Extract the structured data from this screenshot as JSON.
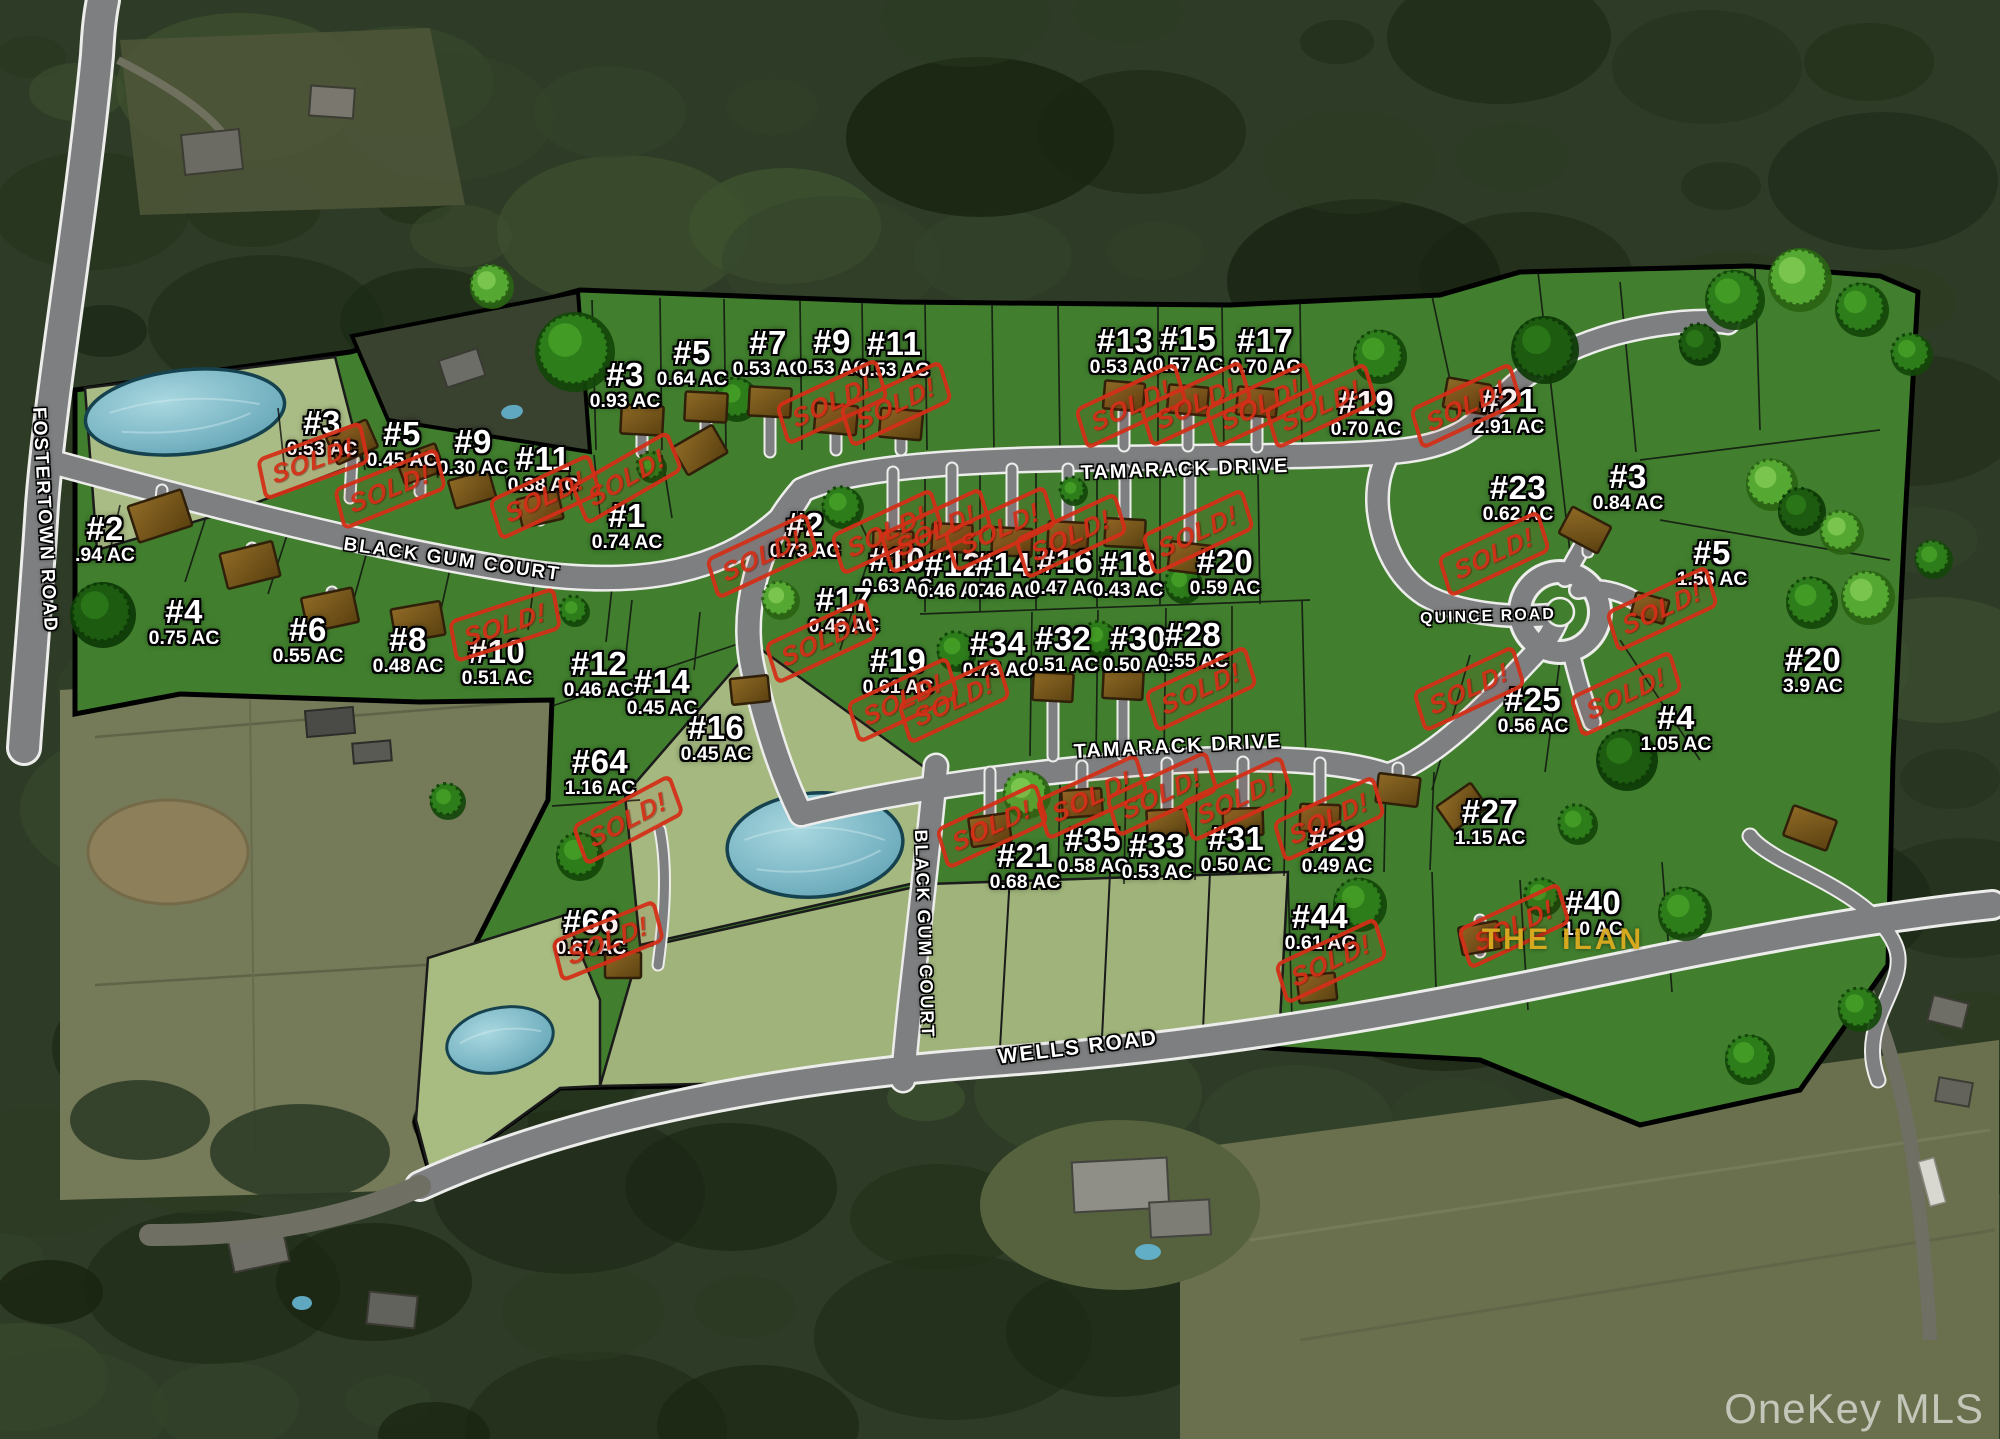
{
  "map": {
    "watermark": "OneKey MLS",
    "overlay_title": "THE ILAN",
    "sold_label": "SOLD!",
    "colors": {
      "lot_green": "#417f2e",
      "open_green": "#a6ba80",
      "pond_blue": "#79b9c8",
      "road_gray": "#7d7f80",
      "sold_red": "#d42f17",
      "ilan_gold": "#dcab1f"
    }
  },
  "roads": [
    {
      "label": "FOSTERTOWN ROAD",
      "x": 44,
      "y": 520,
      "rot": 87,
      "size": 19
    },
    {
      "label": "BLACK GUM COURT",
      "x": 452,
      "y": 560,
      "rot": 8,
      "size": 19
    },
    {
      "label": "TAMARACK DRIVE",
      "x": 1185,
      "y": 470,
      "rot": -2,
      "size": 20
    },
    {
      "label": "TAMARACK DRIVE",
      "x": 1178,
      "y": 747,
      "rot": -3,
      "size": 20
    },
    {
      "label": "QUINCE ROAD",
      "x": 1488,
      "y": 617,
      "rot": -2,
      "size": 16
    },
    {
      "label": "BLACK GUM COURT",
      "x": 924,
      "y": 934,
      "rot": 88,
      "size": 18
    },
    {
      "label": "WELLS ROAD",
      "x": 1078,
      "y": 1048,
      "rot": -7,
      "size": 21
    }
  ],
  "lots": [
    {
      "num": "#2",
      "acres": ".94 AC",
      "x": 105,
      "y": 539
    },
    {
      "num": "#3",
      "acres": "0.53 AC",
      "x": 322,
      "y": 433
    },
    {
      "num": "#5",
      "acres": "0.45 AC",
      "x": 402,
      "y": 444
    },
    {
      "num": "#9",
      "acres": "0.30 AC",
      "x": 473,
      "y": 452
    },
    {
      "num": "#11",
      "acres": "0.38 AC",
      "x": 543,
      "y": 469
    },
    {
      "num": "#1",
      "acres": "0.74 AC",
      "x": 627,
      "y": 526
    },
    {
      "num": "#4",
      "acres": "0.75 AC",
      "x": 184,
      "y": 622
    },
    {
      "num": "#6",
      "acres": "0.55 AC",
      "x": 308,
      "y": 640
    },
    {
      "num": "#8",
      "acres": "0.48 AC",
      "x": 408,
      "y": 650
    },
    {
      "num": "#10",
      "acres": "0.51 AC",
      "x": 497,
      "y": 662
    },
    {
      "num": "#12",
      "acres": "0.46 AC",
      "x": 599,
      "y": 674
    },
    {
      "num": "#14",
      "acres": "0.45 AC",
      "x": 662,
      "y": 692
    },
    {
      "num": "#16",
      "acres": "0.45 AC",
      "x": 716,
      "y": 738
    },
    {
      "num": "#64",
      "acres": "1.16 AC",
      "x": 600,
      "y": 772
    },
    {
      "num": "#66",
      "acres": "0.87 AC",
      "x": 591,
      "y": 932
    },
    {
      "num": "#3",
      "acres": "0.93 AC",
      "x": 625,
      "y": 385
    },
    {
      "num": "#5",
      "acres": "0.64 AC",
      "x": 692,
      "y": 363
    },
    {
      "num": "#7",
      "acres": "0.53 AC",
      "x": 768,
      "y": 353
    },
    {
      "num": "#9",
      "acres": "0.53 AC",
      "x": 832,
      "y": 352
    },
    {
      "num": "#11",
      "acres": "0.53 AC",
      "x": 894,
      "y": 354
    },
    {
      "num": "#13",
      "acres": "0.53 AC",
      "x": 1125,
      "y": 351
    },
    {
      "num": "#15",
      "acres": "0.57 AC",
      "x": 1188,
      "y": 349
    },
    {
      "num": "#17",
      "acres": "0.70 AC",
      "x": 1265,
      "y": 351
    },
    {
      "num": "#19",
      "acres": "0.70 AC",
      "x": 1366,
      "y": 413
    },
    {
      "num": "#21",
      "acres": "2.91 AC",
      "x": 1509,
      "y": 411
    },
    {
      "num": "#2",
      "acres": "0.73 AC",
      "x": 805,
      "y": 535
    },
    {
      "num": "#10",
      "acres": "0.63 AC",
      "x": 897,
      "y": 570
    },
    {
      "num": "#12",
      "acres": "0.46 AC",
      "x": 953,
      "y": 575
    },
    {
      "num": "#14",
      "acres": "0.46 AC",
      "x": 1003,
      "y": 575
    },
    {
      "num": "#16",
      "acres": "0.47 AC",
      "x": 1065,
      "y": 572
    },
    {
      "num": "#18",
      "acres": "0.43 AC",
      "x": 1128,
      "y": 574
    },
    {
      "num": "#20",
      "acres": "0.59 AC",
      "x": 1225,
      "y": 572
    },
    {
      "num": "#17",
      "acres": "0.49 AC",
      "x": 844,
      "y": 610
    },
    {
      "num": "#19",
      "acres": "0.61 AC",
      "x": 898,
      "y": 671
    },
    {
      "num": "#34",
      "acres": "0.73 AC",
      "x": 998,
      "y": 654
    },
    {
      "num": "#32",
      "acres": "0.51 AC",
      "x": 1063,
      "y": 649
    },
    {
      "num": "#30",
      "acres": "0.50 AC",
      "x": 1138,
      "y": 649
    },
    {
      "num": "#28",
      "acres": "0.55 AC",
      "x": 1193,
      "y": 645
    },
    {
      "num": "#21",
      "acres": "0.68 AC",
      "x": 1025,
      "y": 866
    },
    {
      "num": "#35",
      "acres": "0.58 AC",
      "x": 1093,
      "y": 850
    },
    {
      "num": "#33",
      "acres": "0.53 AC",
      "x": 1157,
      "y": 856
    },
    {
      "num": "#31",
      "acres": "0.50 AC",
      "x": 1236,
      "y": 849
    },
    {
      "num": "#29",
      "acres": "0.49 AC",
      "x": 1337,
      "y": 850
    },
    {
      "num": "#27",
      "acres": "1.15 AC",
      "x": 1490,
      "y": 822
    },
    {
      "num": "#44",
      "acres": "0.61 AC",
      "x": 1320,
      "y": 927
    },
    {
      "num": "#40",
      "acres": "1.0 AC",
      "x": 1593,
      "y": 913
    },
    {
      "num": "#23",
      "acres": "0.62 AC",
      "x": 1518,
      "y": 498
    },
    {
      "num": "#3",
      "acres": "0.84 AC",
      "x": 1628,
      "y": 487
    },
    {
      "num": "#5",
      "acres": "1.56 AC",
      "x": 1712,
      "y": 563
    },
    {
      "num": "#20",
      "acres": "3.9 AC",
      "x": 1813,
      "y": 670
    },
    {
      "num": "#25",
      "acres": "0.56 AC",
      "x": 1533,
      "y": 710
    },
    {
      "num": "#4",
      "acres": "1.05 AC",
      "x": 1676,
      "y": 728
    }
  ],
  "sold_stamps": [
    {
      "x": 313,
      "y": 461,
      "rot": -20
    },
    {
      "x": 390,
      "y": 489,
      "rot": -22
    },
    {
      "x": 545,
      "y": 497,
      "rot": -25
    },
    {
      "x": 627,
      "y": 478,
      "rot": -30
    },
    {
      "x": 505,
      "y": 625,
      "rot": -18
    },
    {
      "x": 628,
      "y": 820,
      "rot": -28
    },
    {
      "x": 608,
      "y": 941,
      "rot": -22
    },
    {
      "x": 832,
      "y": 402,
      "rot": -25
    },
    {
      "x": 896,
      "y": 404,
      "rot": -25
    },
    {
      "x": 1131,
      "y": 406,
      "rot": -25
    },
    {
      "x": 1196,
      "y": 404,
      "rot": -25
    },
    {
      "x": 1261,
      "y": 405,
      "rot": -25
    },
    {
      "x": 1321,
      "y": 406,
      "rot": -25
    },
    {
      "x": 1466,
      "y": 406,
      "rot": -25
    },
    {
      "x": 762,
      "y": 556,
      "rot": -25
    },
    {
      "x": 887,
      "y": 532,
      "rot": -25
    },
    {
      "x": 936,
      "y": 531,
      "rot": -25
    },
    {
      "x": 1000,
      "y": 529,
      "rot": -25
    },
    {
      "x": 1071,
      "y": 536,
      "rot": -25
    },
    {
      "x": 1198,
      "y": 532,
      "rot": -25
    },
    {
      "x": 821,
      "y": 641,
      "rot": -25
    },
    {
      "x": 903,
      "y": 700,
      "rot": -25
    },
    {
      "x": 954,
      "y": 701,
      "rot": -25
    },
    {
      "x": 1201,
      "y": 689,
      "rot": -25
    },
    {
      "x": 992,
      "y": 826,
      "rot": -25
    },
    {
      "x": 1092,
      "y": 797,
      "rot": -25
    },
    {
      "x": 1162,
      "y": 794,
      "rot": -25
    },
    {
      "x": 1237,
      "y": 799,
      "rot": -25
    },
    {
      "x": 1329,
      "y": 819,
      "rot": -25
    },
    {
      "x": 1331,
      "y": 961,
      "rot": -25
    },
    {
      "x": 1514,
      "y": 926,
      "rot": -25
    },
    {
      "x": 1494,
      "y": 554,
      "rot": -25
    },
    {
      "x": 1662,
      "y": 609,
      "rot": -25
    },
    {
      "x": 1469,
      "y": 689,
      "rot": -25
    },
    {
      "x": 1626,
      "y": 694,
      "rot": -25
    }
  ],
  "ilan": {
    "x": 1563,
    "y": 940
  }
}
